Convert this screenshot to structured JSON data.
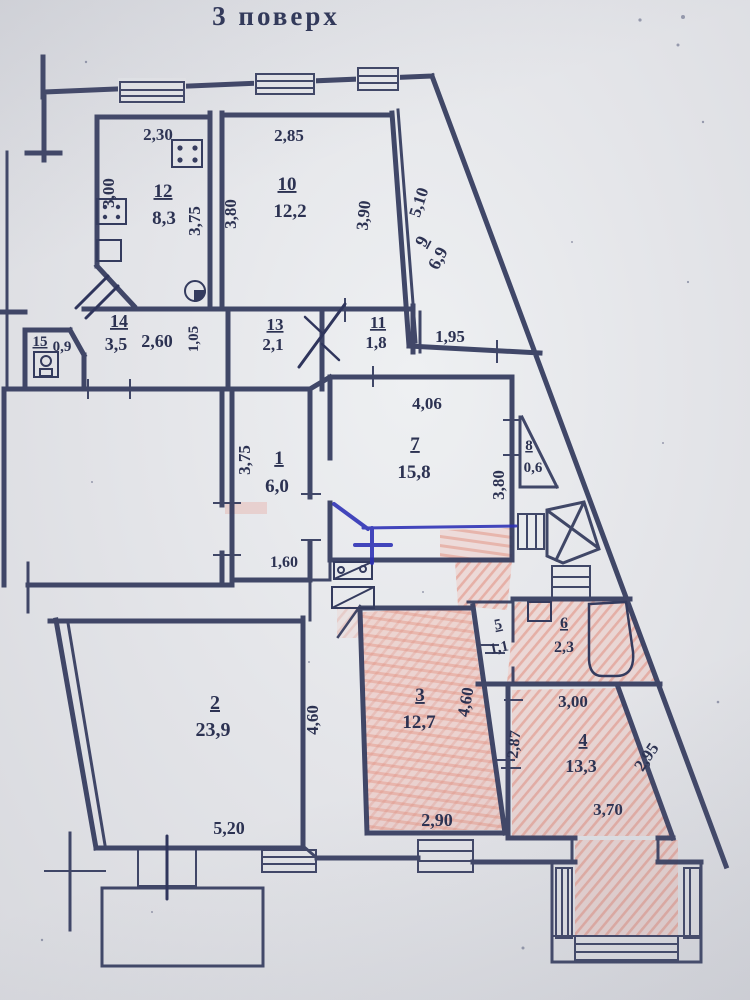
{
  "title": "3 поверх",
  "colors": {
    "paper": "#e3e4e8",
    "ink": "#343b5e",
    "pink_hatch": "#e8998c",
    "blue_pen": "#2b2fb5"
  },
  "rooms": [
    {
      "number": "1",
      "area_m2": "6,0"
    },
    {
      "number": "2",
      "area_m2": "23,9"
    },
    {
      "number": "3",
      "area_m2": "12,7"
    },
    {
      "number": "4",
      "area_m2": "13,3"
    },
    {
      "number": "5",
      "area_m2": "1,1"
    },
    {
      "number": "6",
      "area_m2": "2,3"
    },
    {
      "number": "7",
      "area_m2": "15,8"
    },
    {
      "number": "8",
      "area_m2": "0,6"
    },
    {
      "number": "9",
      "area_m2": "6,9"
    },
    {
      "number": "10",
      "area_m2": "12,2"
    },
    {
      "number": "11",
      "area_m2": "1,8"
    },
    {
      "number": "12",
      "area_m2": "8,3"
    },
    {
      "number": "13",
      "area_m2": "2,1"
    },
    {
      "number": "14",
      "area_m2": "3,5"
    },
    {
      "number": "15",
      "area_m2": "0,9"
    }
  ],
  "labels": [
    {
      "name": "room-12-number",
      "text": "12",
      "x": 163,
      "y": 197,
      "s": 19,
      "u": 1
    },
    {
      "name": "room-12-area",
      "text": "8,3",
      "x": 164,
      "y": 224,
      "s": 19
    },
    {
      "name": "room-10-number",
      "text": "10",
      "x": 287,
      "y": 190,
      "s": 19,
      "u": 1
    },
    {
      "name": "room-10-area",
      "text": "12,2",
      "x": 290,
      "y": 217,
      "s": 19
    },
    {
      "name": "room-9-number",
      "text": "9",
      "x": 427,
      "y": 244,
      "s": 18,
      "r": -62,
      "u": 1
    },
    {
      "name": "room-9-area",
      "text": "6,9",
      "x": 443,
      "y": 261,
      "s": 18,
      "r": -62
    },
    {
      "name": "room-14-number",
      "text": "14",
      "x": 119,
      "y": 327,
      "s": 18,
      "u": 1
    },
    {
      "name": "room-14-area",
      "text": "3,5",
      "x": 116,
      "y": 350,
      "s": 18
    },
    {
      "name": "room-13-number",
      "text": "13",
      "x": 275,
      "y": 330,
      "s": 17,
      "u": 1
    },
    {
      "name": "room-13-area",
      "text": "2,1",
      "x": 273,
      "y": 350,
      "s": 17
    },
    {
      "name": "room-11-number",
      "text": "11",
      "x": 378,
      "y": 328,
      "s": 17,
      "u": 1
    },
    {
      "name": "room-11-area",
      "text": "1,8",
      "x": 376,
      "y": 348,
      "s": 17
    },
    {
      "name": "room-15-number",
      "text": "15",
      "x": 40,
      "y": 346,
      "s": 15,
      "u": 1
    },
    {
      "name": "room-15-area",
      "text": "0,9",
      "x": 62,
      "y": 351,
      "s": 15
    },
    {
      "name": "room-1-number",
      "text": "1",
      "x": 279,
      "y": 464,
      "s": 19,
      "u": 1
    },
    {
      "name": "room-1-area",
      "text": "6,0",
      "x": 277,
      "y": 492,
      "s": 19
    },
    {
      "name": "room-7-number",
      "text": "7",
      "x": 415,
      "y": 450,
      "s": 19,
      "u": 1
    },
    {
      "name": "room-7-area",
      "text": "15,8",
      "x": 414,
      "y": 478,
      "s": 19
    },
    {
      "name": "room-8-number",
      "text": "8",
      "x": 529,
      "y": 450,
      "s": 15,
      "u": 1
    },
    {
      "name": "room-8-area",
      "text": "0,6",
      "x": 533,
      "y": 472,
      "s": 15
    },
    {
      "name": "room-2-number",
      "text": "2",
      "x": 215,
      "y": 709,
      "s": 20,
      "u": 1
    },
    {
      "name": "room-2-area",
      "text": "23,9",
      "x": 213,
      "y": 736,
      "s": 20
    },
    {
      "name": "room-3-number",
      "text": "3",
      "x": 420,
      "y": 701,
      "s": 19,
      "u": 1
    },
    {
      "name": "room-3-area",
      "text": "12,7",
      "x": 419,
      "y": 728,
      "s": 19
    },
    {
      "name": "room-5-number",
      "text": "5",
      "x": 499,
      "y": 629,
      "s": 15,
      "r": -12,
      "u": 1
    },
    {
      "name": "room-5-area",
      "text": "1,1",
      "x": 500,
      "y": 652,
      "s": 15,
      "r": -12
    },
    {
      "name": "room-6-number",
      "text": "6",
      "x": 564,
      "y": 628,
      "s": 16,
      "u": 1
    },
    {
      "name": "room-6-area",
      "text": "2,3",
      "x": 564,
      "y": 652,
      "s": 16
    },
    {
      "name": "room-4-number",
      "text": "4",
      "x": 583,
      "y": 746,
      "s": 18,
      "u": 1
    },
    {
      "name": "room-4-area",
      "text": "13,3",
      "x": 581,
      "y": 772,
      "s": 18
    },
    {
      "name": "dim-2-30-room12",
      "text": "2,30",
      "x": 158,
      "y": 140,
      "s": 17
    },
    {
      "name": "dim-3-00-room12",
      "text": "3,00",
      "x": 114,
      "y": 193,
      "s": 17,
      "r": -90
    },
    {
      "name": "dim-3-75-room12",
      "text": "3,75",
      "x": 200,
      "y": 221,
      "s": 17,
      "r": -90
    },
    {
      "name": "dim-2-85-room10",
      "text": "2,85",
      "x": 289,
      "y": 141,
      "s": 17
    },
    {
      "name": "dim-3-80-room10",
      "text": "3,80",
      "x": 236,
      "y": 214,
      "s": 17,
      "r": -90
    },
    {
      "name": "dim-3-90-room10",
      "text": "3,90",
      "x": 369,
      "y": 216,
      "s": 17,
      "r": -84
    },
    {
      "name": "dim-5-10-room9",
      "text": "5,10",
      "x": 424,
      "y": 204,
      "s": 17,
      "r": -72
    },
    {
      "name": "dim-2-60-room14",
      "text": "2,60",
      "x": 157,
      "y": 347,
      "s": 18
    },
    {
      "name": "dim-1-05",
      "text": "1,05",
      "x": 198,
      "y": 339,
      "s": 15,
      "r": -90
    },
    {
      "name": "dim-1-95",
      "text": "1,95",
      "x": 450,
      "y": 342,
      "s": 17
    },
    {
      "name": "dim-3-75-room1",
      "text": "3,75",
      "x": 250,
      "y": 460,
      "s": 17,
      "r": -90
    },
    {
      "name": "dim-1-60-room1",
      "text": "1,60",
      "x": 284,
      "y": 567,
      "s": 16
    },
    {
      "name": "dim-4-06-room7",
      "text": "4,06",
      "x": 427,
      "y": 409,
      "s": 17
    },
    {
      "name": "dim-3-80-room7",
      "text": "3,80",
      "x": 504,
      "y": 485,
      "s": 17,
      "r": -90
    },
    {
      "name": "dim-4-60-room2",
      "text": "4,60",
      "x": 318,
      "y": 720,
      "s": 17,
      "r": -90
    },
    {
      "name": "dim-5-20-room2",
      "text": "5,20",
      "x": 229,
      "y": 834,
      "s": 18
    },
    {
      "name": "dim-4-60-room3",
      "text": "4,60",
      "x": 471,
      "y": 703,
      "s": 17,
      "r": -80
    },
    {
      "name": "dim-2-90-room3",
      "text": "2,90",
      "x": 437,
      "y": 826,
      "s": 18
    },
    {
      "name": "dim-2-87-room4",
      "text": "2,87",
      "x": 519,
      "y": 745,
      "s": 16,
      "r": -84
    },
    {
      "name": "dim-3-00-room4",
      "text": "3,00",
      "x": 573,
      "y": 707,
      "s": 17
    },
    {
      "name": "dim-2-95-room4",
      "text": "2,95",
      "x": 651,
      "y": 760,
      "s": 17,
      "r": -56
    },
    {
      "name": "dim-3-70-room4",
      "text": "3,70",
      "x": 608,
      "y": 815,
      "s": 17
    }
  ]
}
